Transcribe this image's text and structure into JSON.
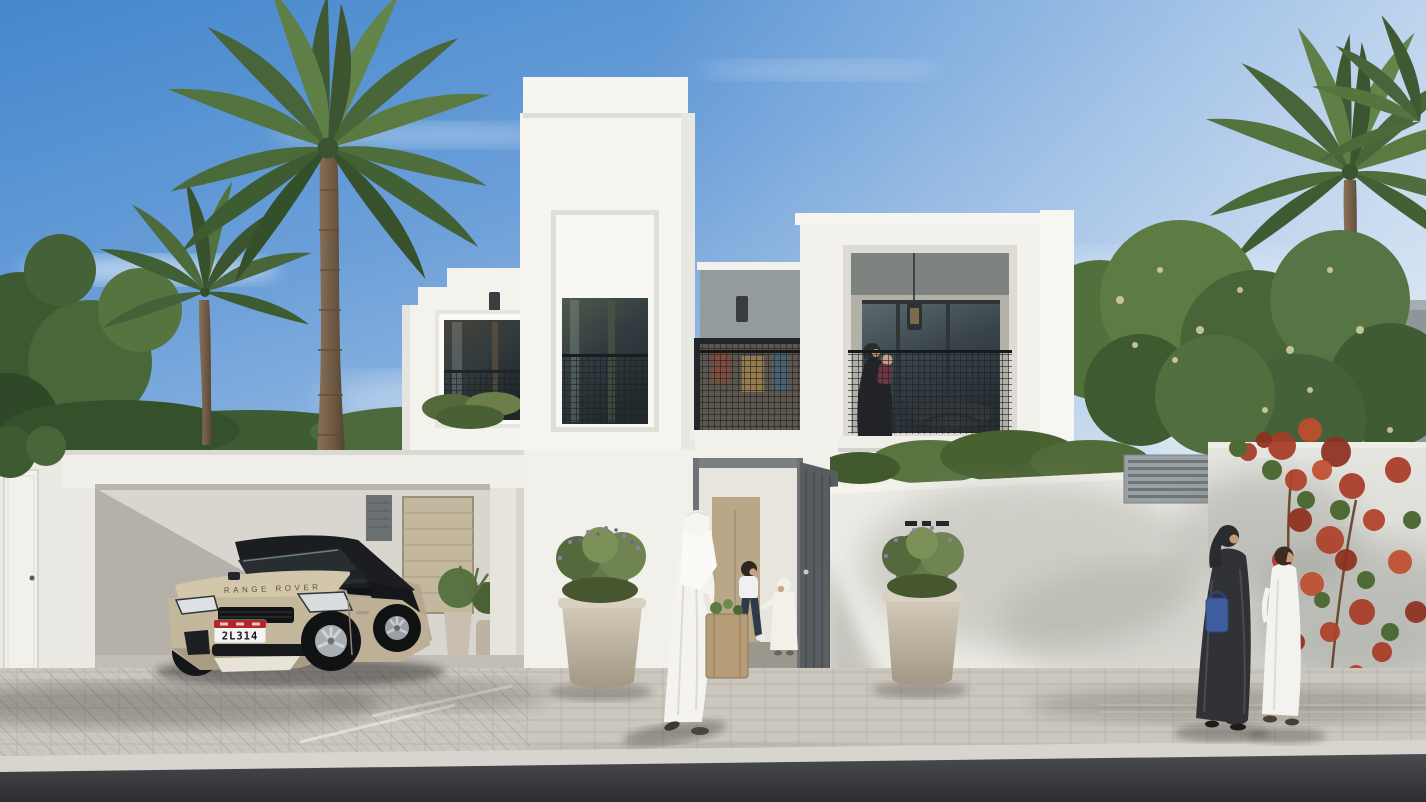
{
  "scene": {
    "kind": "architectural exterior rendering",
    "subject": "modern two-storey white villa with carport, palm trees and family figures"
  },
  "texts": {
    "house_number": "007",
    "car_plate_number": "2L314",
    "car_hood_brand": "RANGE ROVER"
  },
  "palette": {
    "sky-top": "#4487cd",
    "sky-mid": "#8fb5e0",
    "sky-horizon": "#e6edf4",
    "facade-white": "#f4f3ee",
    "facade-shade": "#e3e1da",
    "recess-gray": "#939b9f",
    "window-frame": "#33393d",
    "glass": "#3c4a51",
    "mesh-black": "#1f2326",
    "pavement": "#cbc6be",
    "curb": "#d8d5cf",
    "road": "#3c3f43",
    "car-body": "#cdc0a5",
    "car-roof": "#1b1d20",
    "plate-red": "#b5252a",
    "foliage-dark": "#3f5c33",
    "foliage-mid": "#5d7a41",
    "foliage-light": "#7e9a55",
    "blossom": "#d9d3a4",
    "bougainvillea-red": "#b0402a",
    "planter": "#c7bdab",
    "kandura-white": "#f5f4f0",
    "abaya-black": "#313236",
    "bag-brown": "#b59b76",
    "bag-blue": "#3f5d9e",
    "trunk-brown": "#7a6248"
  }
}
